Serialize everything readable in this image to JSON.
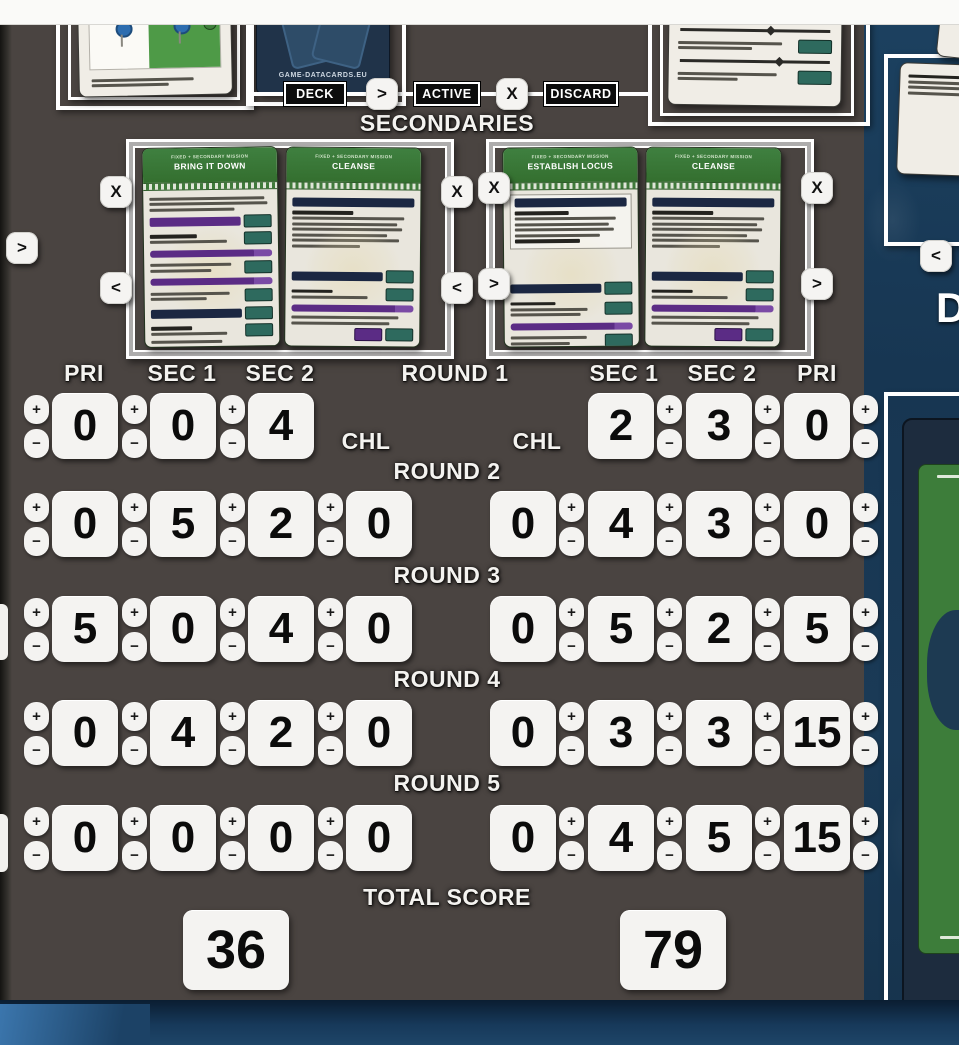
{
  "controls": {
    "plus": "+",
    "minus": "−",
    "close": "X",
    "next": ">",
    "prev": "<"
  },
  "pipeline": {
    "deck": "DECK",
    "active": "ACTIVE",
    "discard": "DISCARD"
  },
  "top": {
    "brand": "GAME-DATACARDS.EU",
    "neighbor_letter": "D"
  },
  "secondaries": {
    "title": "SECONDARIES",
    "left_cards": [
      {
        "type_line": "FIXED + SECONDARY MISSION",
        "title": "BRING IT DOWN"
      },
      {
        "type_line": "FIXED + SECONDARY MISSION",
        "title": "CLEANSE"
      }
    ],
    "right_cards": [
      {
        "type_line": "FIXED + SECONDARY MISSION",
        "title": "ESTABLISH LOCUS"
      },
      {
        "type_line": "FIXED + SECONDARY MISSION",
        "title": "CLEANSE"
      }
    ]
  },
  "scoreboard": {
    "left_headers": [
      "PRI",
      "SEC 1",
      "SEC 2"
    ],
    "right_headers": [
      "SEC 1",
      "SEC 2",
      "PRI"
    ],
    "chl": "CHL",
    "rounds": [
      {
        "label": "ROUND 1",
        "left": [
          "0",
          "0",
          "4"
        ],
        "right": [
          "2",
          "3",
          "0"
        ]
      },
      {
        "label": "ROUND 2",
        "left": [
          "0",
          "5",
          "2",
          "0"
        ],
        "right": [
          "0",
          "4",
          "3",
          "0"
        ]
      },
      {
        "label": "ROUND 3",
        "left": [
          "5",
          "0",
          "4",
          "0"
        ],
        "right": [
          "0",
          "5",
          "2",
          "5"
        ]
      },
      {
        "label": "ROUND 4",
        "left": [
          "0",
          "4",
          "2",
          "0"
        ],
        "right": [
          "0",
          "3",
          "3",
          "15"
        ]
      },
      {
        "label": "ROUND 5",
        "left": [
          "0",
          "0",
          "0",
          "0"
        ],
        "right": [
          "0",
          "4",
          "5",
          "15"
        ]
      }
    ],
    "total_label": "TOTAL SCORE",
    "totals": {
      "left": "36",
      "right": "79"
    }
  },
  "colors": {
    "board": "#4a4441",
    "table_blue": "#1a3a56",
    "card_green": "#3f8040",
    "accent_purple": "#5b2c85",
    "accent_teal": "#2e6a5e",
    "counter_white": "#f4f3f1"
  }
}
